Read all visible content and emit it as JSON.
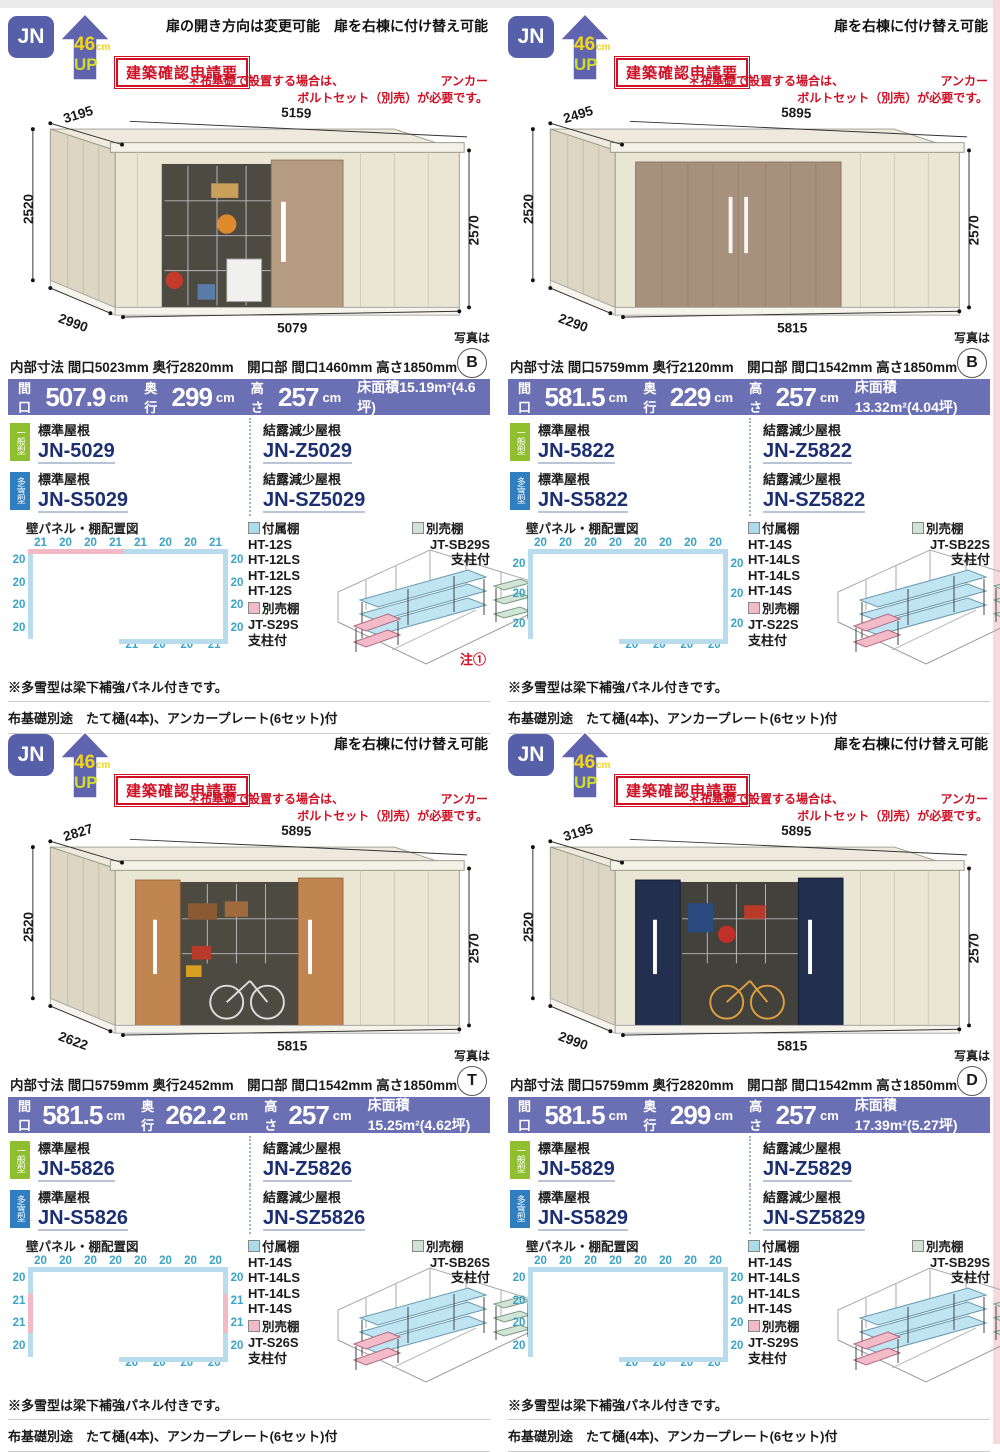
{
  "shared": {
    "jn": "JN",
    "up_num": "46",
    "up_cm": "cm",
    "up_word": "UP",
    "kakunin": "建築確認申請要",
    "red_line1a": "＊布基礎で設置する場合は、",
    "red_line1b": "アンカー",
    "red_line2": "ボルトセット（別売）が必要です。",
    "photo_label": "写真は",
    "banner_labels": {
      "maguchi": "間口",
      "okuyuki": "奥行",
      "takasa": "高さ",
      "menseki": "床面積",
      "unit": "cm"
    },
    "roof_std": "標準屋根",
    "roof_z": "結露減少屋根",
    "type_general": "一般型",
    "type_snow": "多雪型",
    "panel_title": "壁パネル・棚配置図",
    "legend_fuzoku": "付属棚",
    "legend_betsu": "別売棚",
    "shichu": "支柱付",
    "note_snow": "※多雪型は梁下補強パネル付きです。",
    "note_base": "布基礎別途　たて樋(4本)、アンカープレート(6セット)付"
  },
  "quadrants": [
    {
      "header_note": "扉の開き方向は変更可能　扉を右棟に付け替え可能",
      "dims": {
        "diag": "3195",
        "top": "5159",
        "left": "2520",
        "right": "2570",
        "depth": "2990",
        "bottom": "5079"
      },
      "photo_letter": "B",
      "spec": "内部寸法 間口5023mm 奥行2820mm　開口部 間口1460mm 高さ1850mm",
      "banner": {
        "maguchi": "507.9",
        "okuyuki": "299",
        "takasa": "257",
        "area": "15.19m²(4.6坪)"
      },
      "models": {
        "std": "JN-5029",
        "z": "JN-Z5029",
        "s": "JN-S5029",
        "sz": "JN-SZ5029"
      },
      "panels": {
        "top": [
          "21",
          "20",
          "20",
          "21",
          "21",
          "20",
          "20",
          "21"
        ],
        "left": [
          "20",
          "20",
          "20",
          "20"
        ],
        "right": [
          "20",
          "20",
          "20",
          "20"
        ],
        "bottom": [
          "21",
          "20",
          "20",
          "21"
        ]
      },
      "shelves": {
        "fuzoku": [
          "HT-12S",
          "HT-12LS",
          "HT-12LS",
          "HT-12S"
        ],
        "pink_code": "JT-S29S",
        "gray_code": "JT-SB29S",
        "note": "注①"
      }
    },
    {
      "header_note": "扉を右棟に付け替え可能",
      "dims": {
        "diag": "2495",
        "top": "5895",
        "left": "2520",
        "right": "2570",
        "depth": "2290",
        "bottom": "5815"
      },
      "photo_letter": "B",
      "spec": "内部寸法 間口5759mm 奥行2120mm　開口部 間口1542mm 高さ1850mm",
      "banner": {
        "maguchi": "581.5",
        "okuyuki": "229",
        "takasa": "257",
        "area": "13.32m²(4.04坪)"
      },
      "models": {
        "std": "JN-5822",
        "z": "JN-Z5822",
        "s": "JN-S5822",
        "sz": "JN-SZ5822"
      },
      "panels": {
        "top": [
          "20",
          "20",
          "20",
          "20",
          "20",
          "20",
          "20",
          "20"
        ],
        "left": [
          "20",
          "20",
          "20"
        ],
        "right": [
          "20",
          "20",
          "20"
        ],
        "bottom": [
          "20",
          "20",
          "20",
          "20"
        ]
      },
      "shelves": {
        "fuzoku": [
          "HT-14S",
          "HT-14LS",
          "HT-14LS",
          "HT-14S"
        ],
        "pink_code": "JT-S22S",
        "gray_code": "JT-SB22S",
        "note": ""
      }
    },
    {
      "header_note": "扉を右棟に付け替え可能",
      "dims": {
        "diag": "2827",
        "top": "5895",
        "left": "2520",
        "right": "2570",
        "depth": "2622",
        "bottom": "5815"
      },
      "photo_letter": "T",
      "spec": "内部寸法 間口5759mm 奥行2452mm　開口部 間口1542mm 高さ1850mm",
      "banner": {
        "maguchi": "581.5",
        "okuyuki": "262.2",
        "takasa": "257",
        "area": "15.25m²(4.62坪)"
      },
      "models": {
        "std": "JN-5826",
        "z": "JN-Z5826",
        "s": "JN-S5826",
        "sz": "JN-SZ5826"
      },
      "panels": {
        "top": [
          "20",
          "20",
          "20",
          "20",
          "20",
          "20",
          "20",
          "20"
        ],
        "left": [
          "20",
          "21",
          "21",
          "20"
        ],
        "right": [
          "20",
          "21",
          "21",
          "20"
        ],
        "bottom": [
          "20",
          "20",
          "20",
          "20"
        ]
      },
      "shelves": {
        "fuzoku": [
          "HT-14S",
          "HT-14LS",
          "HT-14LS",
          "HT-14S"
        ],
        "pink_code": "JT-S26S",
        "gray_code": "JT-SB26S",
        "note": ""
      }
    },
    {
      "header_note": "扉を右棟に付け替え可能",
      "dims": {
        "diag": "3195",
        "top": "5895",
        "left": "2520",
        "right": "2570",
        "depth": "2990",
        "bottom": "5815"
      },
      "photo_letter": "D",
      "spec": "内部寸法 間口5759mm 奥行2820mm　開口部 間口1542mm 高さ1850mm",
      "banner": {
        "maguchi": "581.5",
        "okuyuki": "299",
        "takasa": "257",
        "area": "17.39m²(5.27坪)"
      },
      "models": {
        "std": "JN-5829",
        "z": "JN-Z5829",
        "s": "JN-S5829",
        "sz": "JN-SZ5829"
      },
      "panels": {
        "top": [
          "20",
          "20",
          "20",
          "20",
          "20",
          "20",
          "20",
          "20"
        ],
        "left": [
          "20",
          "20",
          "20",
          "20"
        ],
        "right": [
          "20",
          "20",
          "20",
          "20"
        ],
        "bottom": [
          "20",
          "20",
          "20",
          "20"
        ]
      },
      "shelves": {
        "fuzoku": [
          "HT-14S",
          "HT-14LS",
          "HT-14LS",
          "HT-14S"
        ],
        "pink_code": "JT-S29S",
        "gray_code": "JT-SB29S",
        "note": ""
      }
    }
  ]
}
